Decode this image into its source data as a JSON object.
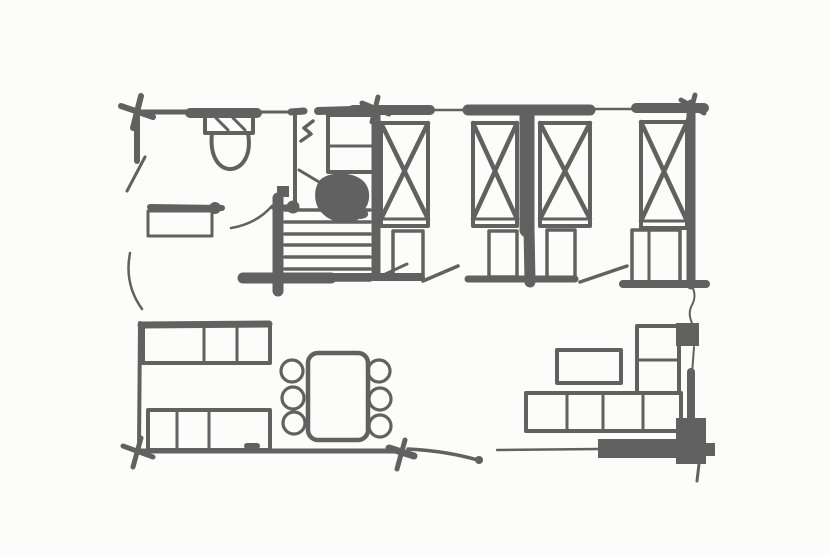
{
  "meta": {
    "description": "hand-drawn floor plan sketch",
    "canvas_width": 830,
    "canvas_height": 555,
    "ink_color": "#616161",
    "background_color": "#fcfcfb"
  },
  "plan": {
    "elements": [
      {
        "name": "top-wall-seg-1",
        "kind": "line",
        "x1": 137,
        "y1": 112,
        "x2": 193,
        "y2": 112,
        "w": 5
      },
      {
        "name": "top-wall-seg-2",
        "kind": "line",
        "x1": 190,
        "y1": 113,
        "x2": 257,
        "y2": 113,
        "w": 10
      },
      {
        "name": "top-wall-seg-3",
        "kind": "line",
        "x1": 257,
        "y1": 112,
        "x2": 289,
        "y2": 112,
        "w": 3
      },
      {
        "name": "top-wall-seg-4",
        "kind": "line",
        "x1": 291,
        "y1": 112,
        "x2": 304,
        "y2": 111,
        "w": 7
      },
      {
        "name": "top-wall-seg-5",
        "kind": "line",
        "x1": 318,
        "y1": 111,
        "x2": 353,
        "y2": 110,
        "w": 8
      },
      {
        "name": "top-wall-seg-6",
        "kind": "line",
        "x1": 353,
        "y1": 110,
        "x2": 430,
        "y2": 110,
        "w": 10
      },
      {
        "name": "top-wall-window-1",
        "kind": "line",
        "x1": 430,
        "y1": 110,
        "x2": 470,
        "y2": 110,
        "w": 2.5
      },
      {
        "name": "top-wall-seg-7",
        "kind": "line",
        "x1": 468,
        "y1": 110,
        "x2": 590,
        "y2": 110,
        "w": 11
      },
      {
        "name": "top-wall-window-2",
        "kind": "line",
        "x1": 590,
        "y1": 109,
        "x2": 638,
        "y2": 109,
        "w": 2.5
      },
      {
        "name": "top-wall-seg-8",
        "kind": "line",
        "x1": 636,
        "y1": 108,
        "x2": 704,
        "y2": 108,
        "w": 10
      },
      {
        "name": "left-wall-upper",
        "kind": "line",
        "x1": 137,
        "y1": 112,
        "x2": 137,
        "y2": 161,
        "w": 6
      },
      {
        "name": "entry-door-leaf",
        "kind": "line",
        "x1": 145,
        "y1": 157,
        "x2": 127,
        "y2": 191,
        "w": 3
      },
      {
        "name": "left-door-arc",
        "kind": "path",
        "d": "M 130 253 Q 124 284 142 309",
        "w": 2.5
      },
      {
        "name": "stairwell-partition-wall",
        "kind": "line",
        "x1": 376,
        "y1": 112,
        "x2": 376,
        "y2": 276,
        "w": 9
      },
      {
        "name": "bedroom-partition-wall-upper",
        "kind": "line",
        "x1": 527,
        "y1": 112,
        "x2": 527,
        "y2": 230,
        "w": 15
      },
      {
        "name": "bedroom-partition-wall-lower",
        "kind": "line",
        "x1": 529,
        "y1": 228,
        "x2": 530,
        "y2": 282,
        "w": 11
      },
      {
        "name": "right-wall-upper",
        "kind": "line",
        "x1": 691,
        "y1": 104,
        "x2": 691,
        "y2": 285,
        "w": 9
      },
      {
        "name": "right-wall-squiggle",
        "kind": "path",
        "d": "M 692 286 q 5 10 0 19 q -5 9 1 20",
        "w": 2
      },
      {
        "name": "right-wall-thin",
        "kind": "line",
        "x1": 694,
        "y1": 347,
        "x2": 692,
        "y2": 374,
        "w": 2
      },
      {
        "name": "right-wall-lower",
        "kind": "line",
        "x1": 691,
        "y1": 372,
        "x2": 691,
        "y2": 424,
        "w": 8
      },
      {
        "name": "stairs-base-wall",
        "kind": "line",
        "x1": 243,
        "y1": 278,
        "x2": 331,
        "y2": 278,
        "w": 11
      },
      {
        "name": "bedroom-south-wall-1",
        "kind": "line",
        "x1": 331,
        "y1": 277,
        "x2": 421,
        "y2": 277,
        "w": 8
      },
      {
        "name": "bedroom-door-swing-0",
        "kind": "line",
        "x1": 381,
        "y1": 276,
        "x2": 407,
        "y2": 264,
        "w": 3
      },
      {
        "name": "bedroom-door-swing-1",
        "kind": "line",
        "x1": 423,
        "y1": 281,
        "x2": 458,
        "y2": 266,
        "w": 3.5
      },
      {
        "name": "bedroom-south-wall-2",
        "kind": "line",
        "x1": 468,
        "y1": 279,
        "x2": 575,
        "y2": 279,
        "w": 7
      },
      {
        "name": "bedroom-door-swing-2",
        "kind": "line",
        "x1": 580,
        "y1": 282,
        "x2": 627,
        "y2": 266,
        "w": 3.5
      },
      {
        "name": "bedroom-south-wall-3",
        "kind": "line",
        "x1": 623,
        "y1": 284,
        "x2": 706,
        "y2": 284,
        "w": 8
      },
      {
        "name": "bottom-wall-west",
        "kind": "line",
        "x1": 137,
        "y1": 451,
        "x2": 398,
        "y2": 451,
        "w": 5
      },
      {
        "name": "bottom-wall-curve",
        "kind": "path",
        "d": "M 408 449 Q 448 451 481 461",
        "w": 3.5
      },
      {
        "name": "bottom-wall-curve-end",
        "kind": "circle",
        "cx": 479,
        "cy": 460,
        "r": 4,
        "fill": true
      },
      {
        "name": "bottom-wall-thin",
        "kind": "line",
        "x1": 497,
        "y1": 450,
        "x2": 598,
        "y2": 449,
        "w": 2.5
      },
      {
        "name": "sofa-base-dark-bar",
        "kind": "rect",
        "x": 598,
        "y": 439,
        "w": 80,
        "h": 19,
        "fill": true
      },
      {
        "name": "bottom-right-corner-block",
        "kind": "rect",
        "x": 676,
        "y": 418,
        "w": 30,
        "h": 46,
        "fill": true
      },
      {
        "name": "bottom-right-corner-nub",
        "kind": "rect",
        "x": 704,
        "y": 443,
        "w": 11,
        "h": 13,
        "fill": true
      },
      {
        "name": "bottom-right-corner-tail",
        "kind": "line",
        "x1": 699,
        "y1": 464,
        "x2": 697,
        "y2": 481,
        "w": 3
      },
      {
        "name": "right-wall-fixture",
        "kind": "rect",
        "x": 676,
        "y": 323,
        "w": 23,
        "h": 23,
        "fill": true
      },
      {
        "name": "bathroom-east-wall",
        "kind": "line",
        "x1": 295,
        "y1": 116,
        "x2": 295,
        "y2": 203,
        "w": 4
      },
      {
        "name": "bathroom-wall-corner-blob",
        "kind": "circle",
        "cx": 293,
        "cy": 207,
        "r": 6.5,
        "fill": true
      },
      {
        "name": "bathroom-south-wall",
        "kind": "line",
        "x1": 273,
        "y1": 207,
        "x2": 290,
        "y2": 207,
        "w": 5
      },
      {
        "name": "vanity-counter-edge",
        "kind": "line",
        "x1": 150,
        "y1": 207,
        "x2": 222,
        "y2": 208,
        "w": 6
      },
      {
        "name": "vanity-corner-blob",
        "kind": "circle",
        "cx": 215,
        "cy": 208,
        "r": 6,
        "fill": true
      },
      {
        "name": "vanity-cabinet",
        "kind": "rect",
        "x": 148,
        "y": 211,
        "w": 64,
        "h": 25,
        "sw": 3
      },
      {
        "name": "bathroom-door-arc",
        "kind": "path",
        "d": "M 231 228 Q 256 224 272 206",
        "w": 2.5
      },
      {
        "name": "corner-marker-tl-a",
        "kind": "line",
        "x1": 121,
        "y1": 106,
        "x2": 153,
        "y2": 117,
        "w": 6
      },
      {
        "name": "corner-marker-tl-b",
        "kind": "line",
        "x1": 141,
        "y1": 96,
        "x2": 133,
        "y2": 128,
        "w": 6
      },
      {
        "name": "corner-marker-tm-a",
        "kind": "line",
        "x1": 362,
        "y1": 103,
        "x2": 389,
        "y2": 114,
        "w": 5
      },
      {
        "name": "corner-marker-tm-b",
        "kind": "line",
        "x1": 378,
        "y1": 97,
        "x2": 372,
        "y2": 122,
        "w": 5
      },
      {
        "name": "corner-marker-tr-a",
        "kind": "line",
        "x1": 681,
        "y1": 100,
        "x2": 704,
        "y2": 113,
        "w": 5
      },
      {
        "name": "corner-marker-tr-b",
        "kind": "line",
        "x1": 695,
        "y1": 95,
        "x2": 688,
        "y2": 121,
        "w": 5
      },
      {
        "name": "corner-marker-bl-a",
        "kind": "line",
        "x1": 123,
        "y1": 446,
        "x2": 153,
        "y2": 457,
        "w": 5
      },
      {
        "name": "corner-marker-bl-b",
        "kind": "line",
        "x1": 141,
        "y1": 438,
        "x2": 133,
        "y2": 467,
        "w": 5
      },
      {
        "name": "corner-marker-bm-a",
        "kind": "line",
        "x1": 389,
        "y1": 448,
        "x2": 414,
        "y2": 456,
        "w": 7
      },
      {
        "name": "corner-marker-bm-b",
        "kind": "line",
        "x1": 405,
        "y1": 440,
        "x2": 397,
        "y2": 469,
        "w": 5
      },
      {
        "name": "toilet-tank",
        "kind": "rect",
        "x": 205,
        "y": 115,
        "w": 48,
        "h": 18,
        "sw": 4
      },
      {
        "name": "toilet-tank-hatch-1",
        "kind": "line",
        "x1": 216,
        "y1": 118,
        "x2": 228,
        "y2": 130,
        "w": 3
      },
      {
        "name": "toilet-tank-hatch-2",
        "kind": "line",
        "x1": 233,
        "y1": 118,
        "x2": 245,
        "y2": 130,
        "w": 3
      },
      {
        "name": "toilet-bowl",
        "kind": "path",
        "d": "M 212 133 C 209 160 222 170 231 169 C 242 168 252 156 248 133",
        "w": 4
      },
      {
        "name": "hall-wardrobe",
        "kind": "rect",
        "x": 328,
        "y": 115,
        "w": 49,
        "h": 57,
        "sw": 4
      },
      {
        "name": "hall-wardrobe-shelf",
        "kind": "line",
        "x1": 328,
        "y1": 146,
        "x2": 377,
        "y2": 146,
        "w": 3
      },
      {
        "name": "door-pivot-symbol",
        "kind": "path",
        "d": "M 301 141 L 311 134 L 304 128 L 313 121",
        "w": 3.5
      },
      {
        "name": "stair-landing-chair-blob",
        "kind": "path",
        "d": "M 321 179 C 331 171 353 172 362 180 C 371 187 371 201 365 209 C 371 214 368 219 359 219 C 347 226 330 222 322 213 C 313 204 313 187 321 179 Z",
        "fill": true
      },
      {
        "name": "hall-dark-square",
        "kind": "rect",
        "x": 277,
        "y": 186,
        "w": 12,
        "h": 11,
        "fill": true
      },
      {
        "name": "blob-spur-line",
        "kind": "line",
        "x1": 299,
        "y1": 170,
        "x2": 319,
        "y2": 182,
        "w": 3
      },
      {
        "name": "stairs-left-rail",
        "kind": "line",
        "x1": 278,
        "y1": 198,
        "x2": 278,
        "y2": 291,
        "w": 11
      },
      {
        "name": "stair-step-1",
        "kind": "line",
        "x1": 285,
        "y1": 210,
        "x2": 370,
        "y2": 210,
        "w": 3.5
      },
      {
        "name": "stair-step-2",
        "kind": "line",
        "x1": 285,
        "y1": 222,
        "x2": 370,
        "y2": 222,
        "w": 3.5
      },
      {
        "name": "stair-step-3",
        "kind": "line",
        "x1": 285,
        "y1": 234,
        "x2": 370,
        "y2": 234,
        "w": 3.5
      },
      {
        "name": "stair-step-4",
        "kind": "line",
        "x1": 285,
        "y1": 245,
        "x2": 370,
        "y2": 245,
        "w": 3.5
      },
      {
        "name": "stair-step-5",
        "kind": "line",
        "x1": 285,
        "y1": 257,
        "x2": 370,
        "y2": 257,
        "w": 3.5
      },
      {
        "name": "stair-step-6",
        "kind": "line",
        "x1": 285,
        "y1": 269,
        "x2": 370,
        "y2": 269,
        "w": 3.5
      },
      {
        "name": "stair-step-7",
        "kind": "line",
        "x1": 285,
        "y1": 280,
        "x2": 370,
        "y2": 280,
        "w": 3.5
      },
      {
        "name": "bed-1-frame",
        "kind": "rect",
        "x": 381,
        "y": 123,
        "w": 47,
        "h": 103,
        "sw": 4
      },
      {
        "name": "bed-1-cross-a",
        "kind": "line",
        "x1": 381,
        "y1": 123,
        "x2": 428,
        "y2": 219,
        "w": 4.5
      },
      {
        "name": "bed-1-cross-b",
        "kind": "line",
        "x1": 428,
        "y1": 123,
        "x2": 381,
        "y2": 219,
        "w": 4.5
      },
      {
        "name": "bed-1-foot-line",
        "kind": "line",
        "x1": 384,
        "y1": 219,
        "x2": 425,
        "y2": 219,
        "w": 3
      },
      {
        "name": "bed-2-frame",
        "kind": "rect",
        "x": 473,
        "y": 123,
        "w": 44,
        "h": 103,
        "sw": 4
      },
      {
        "name": "bed-2-cross-a",
        "kind": "line",
        "x1": 473,
        "y1": 123,
        "x2": 517,
        "y2": 219,
        "w": 4.5
      },
      {
        "name": "bed-2-cross-b",
        "kind": "line",
        "x1": 517,
        "y1": 123,
        "x2": 473,
        "y2": 219,
        "w": 4.5
      },
      {
        "name": "bed-2-foot-line",
        "kind": "line",
        "x1": 476,
        "y1": 219,
        "x2": 514,
        "y2": 219,
        "w": 3
      },
      {
        "name": "bed-3-frame",
        "kind": "rect",
        "x": 540,
        "y": 123,
        "w": 50,
        "h": 103,
        "sw": 4
      },
      {
        "name": "bed-3-cross-a",
        "kind": "line",
        "x1": 540,
        "y1": 123,
        "x2": 590,
        "y2": 219,
        "w": 4.5
      },
      {
        "name": "bed-3-cross-b",
        "kind": "line",
        "x1": 590,
        "y1": 123,
        "x2": 540,
        "y2": 219,
        "w": 4.5
      },
      {
        "name": "bed-3-foot-line",
        "kind": "line",
        "x1": 543,
        "y1": 219,
        "x2": 587,
        "y2": 219,
        "w": 3
      },
      {
        "name": "bed-4-frame",
        "kind": "rect",
        "x": 641,
        "y": 122,
        "w": 46,
        "h": 106,
        "sw": 4
      },
      {
        "name": "bed-4-cross-a",
        "kind": "line",
        "x1": 641,
        "y1": 122,
        "x2": 687,
        "y2": 221,
        "w": 4.5
      },
      {
        "name": "bed-4-cross-b",
        "kind": "line",
        "x1": 687,
        "y1": 122,
        "x2": 641,
        "y2": 221,
        "w": 4.5
      },
      {
        "name": "bed-4-foot-line",
        "kind": "line",
        "x1": 644,
        "y1": 221,
        "x2": 684,
        "y2": 221,
        "w": 3
      },
      {
        "name": "nightstand-1",
        "kind": "rect",
        "x": 393,
        "y": 231,
        "w": 30,
        "h": 44,
        "sw": 3.5
      },
      {
        "name": "nightstand-2",
        "kind": "rect",
        "x": 489,
        "y": 231,
        "w": 28,
        "h": 46,
        "sw": 3.5
      },
      {
        "name": "nightstand-3",
        "kind": "rect",
        "x": 547,
        "y": 230,
        "w": 28,
        "h": 48,
        "sw": 3.5
      },
      {
        "name": "nightstand-4",
        "kind": "rect",
        "x": 632,
        "y": 230,
        "w": 48,
        "h": 52,
        "sw": 3.5
      },
      {
        "name": "nightstand-4-divider",
        "kind": "line",
        "x1": 649,
        "y1": 232,
        "x2": 649,
        "y2": 280,
        "w": 3
      },
      {
        "name": "kitchen-counter-upper",
        "kind": "rect",
        "x": 143,
        "y": 325,
        "w": 127,
        "h": 38,
        "sw": 4
      },
      {
        "name": "kitchen-counter-upper-edge",
        "kind": "line",
        "x1": 141,
        "y1": 325,
        "x2": 269,
        "y2": 324,
        "w": 7
      },
      {
        "name": "kitchen-counter-upper-div-1",
        "kind": "line",
        "x1": 204,
        "y1": 327,
        "x2": 204,
        "y2": 361,
        "w": 3
      },
      {
        "name": "kitchen-counter-upper-div-2",
        "kind": "line",
        "x1": 237,
        "y1": 327,
        "x2": 237,
        "y2": 361,
        "w": 3
      },
      {
        "name": "kitchen-counter-lower",
        "kind": "rect",
        "x": 148,
        "y": 410,
        "w": 122,
        "h": 40,
        "sw": 4
      },
      {
        "name": "kitchen-counter-lower-div-1",
        "kind": "line",
        "x1": 177,
        "y1": 412,
        "x2": 177,
        "y2": 448,
        "w": 3
      },
      {
        "name": "kitchen-counter-lower-div-2",
        "kind": "line",
        "x1": 209,
        "y1": 412,
        "x2": 209,
        "y2": 448,
        "w": 3
      },
      {
        "name": "kitchen-counter-handle",
        "kind": "line",
        "x1": 247,
        "y1": 446,
        "x2": 257,
        "y2": 446,
        "w": 6
      },
      {
        "name": "left-wall-lower",
        "kind": "line",
        "x1": 140,
        "y1": 323,
        "x2": 139,
        "y2": 450,
        "w": 4
      },
      {
        "name": "dining-table",
        "kind": "rect",
        "x": 308,
        "y": 353,
        "w": 60,
        "h": 87,
        "rx": 10,
        "sw": 4.5
      },
      {
        "name": "dining-chair-1",
        "kind": "circle",
        "cx": 292,
        "cy": 371,
        "r": 11,
        "sw": 3.2
      },
      {
        "name": "dining-chair-2",
        "kind": "circle",
        "cx": 293,
        "cy": 398,
        "r": 11,
        "sw": 3.2
      },
      {
        "name": "dining-chair-3",
        "kind": "circle",
        "cx": 294,
        "cy": 423,
        "r": 11,
        "sw": 3.2
      },
      {
        "name": "dining-chair-4",
        "kind": "circle",
        "cx": 379,
        "cy": 371,
        "r": 11,
        "sw": 3.2
      },
      {
        "name": "dining-chair-5",
        "kind": "circle",
        "cx": 380,
        "cy": 399,
        "r": 11,
        "sw": 3.2
      },
      {
        "name": "dining-chair-6",
        "kind": "circle",
        "cx": 380,
        "cy": 426,
        "r": 11,
        "sw": 3.2
      },
      {
        "name": "sofa-seat-row",
        "kind": "rect",
        "x": 526,
        "y": 393,
        "w": 155,
        "h": 38,
        "sw": 4
      },
      {
        "name": "sofa-seat-div-1",
        "kind": "line",
        "x1": 567,
        "y1": 395,
        "x2": 567,
        "y2": 429,
        "w": 3
      },
      {
        "name": "sofa-seat-div-2",
        "kind": "line",
        "x1": 603,
        "y1": 395,
        "x2": 603,
        "y2": 429,
        "w": 3
      },
      {
        "name": "sofa-seat-div-3",
        "kind": "line",
        "x1": 643,
        "y1": 395,
        "x2": 643,
        "y2": 429,
        "w": 3
      },
      {
        "name": "sofa-arm-column",
        "kind": "rect",
        "x": 637,
        "y": 326,
        "w": 42,
        "h": 67,
        "sw": 4
      },
      {
        "name": "sofa-arm-div",
        "kind": "line",
        "x1": 637,
        "y1": 360,
        "x2": 679,
        "y2": 360,
        "w": 3
      },
      {
        "name": "coffee-table",
        "kind": "rect",
        "x": 557,
        "y": 350,
        "w": 64,
        "h": 33,
        "sw": 4
      }
    ]
  }
}
